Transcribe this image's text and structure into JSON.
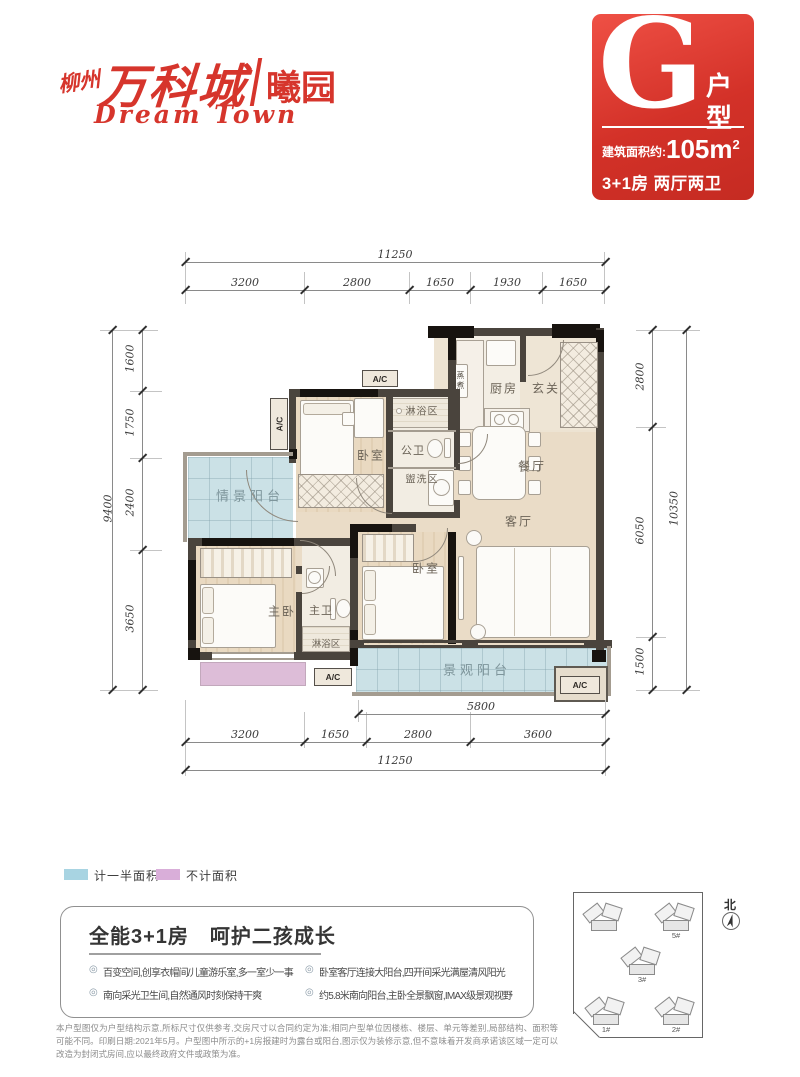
{
  "brand": {
    "city": "柳州",
    "name": "万科城",
    "sub": "曦园",
    "slogan": "Dream Town"
  },
  "badge": {
    "letter": "G",
    "type_char_1": "户",
    "type_char_2": "型",
    "area_prefix": "建筑面积约:",
    "area_value": "105m",
    "area_sup": "2",
    "rooms": "3+1房 两厅两卫"
  },
  "colors": {
    "brand_red": "#d6352c",
    "half_area_blue": "#a8d4e2",
    "excluded_pink": "#d9aed9"
  },
  "plan": {
    "labels": {
      "scenic_balcony": "情景阳台",
      "bedroom": "卧室",
      "shower": "淋浴区",
      "guest_bath": "公卫",
      "wash": "盥洗区",
      "kitchen": "厨房",
      "foyer": "玄关",
      "dining": "餐厅",
      "living": "客厅",
      "master": "主卧",
      "master_bath": "主卫",
      "view_balcony": "景观阳台",
      "ac": "A/C",
      "appliance": "蒸煮"
    },
    "dims": {
      "top_total": "11250",
      "top_segments": [
        "3200",
        "2800",
        "1650",
        "1930",
        "1650"
      ],
      "left_total": "9400",
      "left_segments": [
        "1600",
        "1750",
        "2400",
        "3650"
      ],
      "right_total": "10350",
      "right_segments": [
        "2800",
        "6050",
        "1500"
      ],
      "bottom_inner": "5800",
      "bottom_segments": [
        "3200",
        "1650",
        "2800",
        "3600"
      ],
      "bottom_total": "11250"
    }
  },
  "legend": {
    "half": "计一半面积",
    "none": "不计面积"
  },
  "selling": {
    "title": "全能3+1房　呵护二孩成长",
    "marker": "◎",
    "bullets": [
      "百变空间,创享衣帽间/儿童游乐室,多一室少一事",
      "南向采光卫生间,自然通风时刻保持干爽",
      "卧室客厅连接大阳台,四开间采光满屋清风阳光",
      "约5.8米南向阳台,主卧全景飘窗,IMAX级景观视野"
    ]
  },
  "siteplan": {
    "north": "北",
    "buildings": [
      "4#",
      "5#",
      "3#",
      "1#",
      "2#"
    ]
  },
  "disclaimer": "本户型图仅为户型结构示意,所标尺寸仅供参考,交房尺寸以合同约定为准;相同户型单位因楼栋、楼层、单元等差别,局部结构、面积等可能不同。印刷日期:2021年5月。户型图中所示的+1房报建时为露台或阳台,图示仅为装修示意,但不意味着开发商承诺该区域一定可以改造为封闭式房间,应以最终政府文件或政策为准。"
}
